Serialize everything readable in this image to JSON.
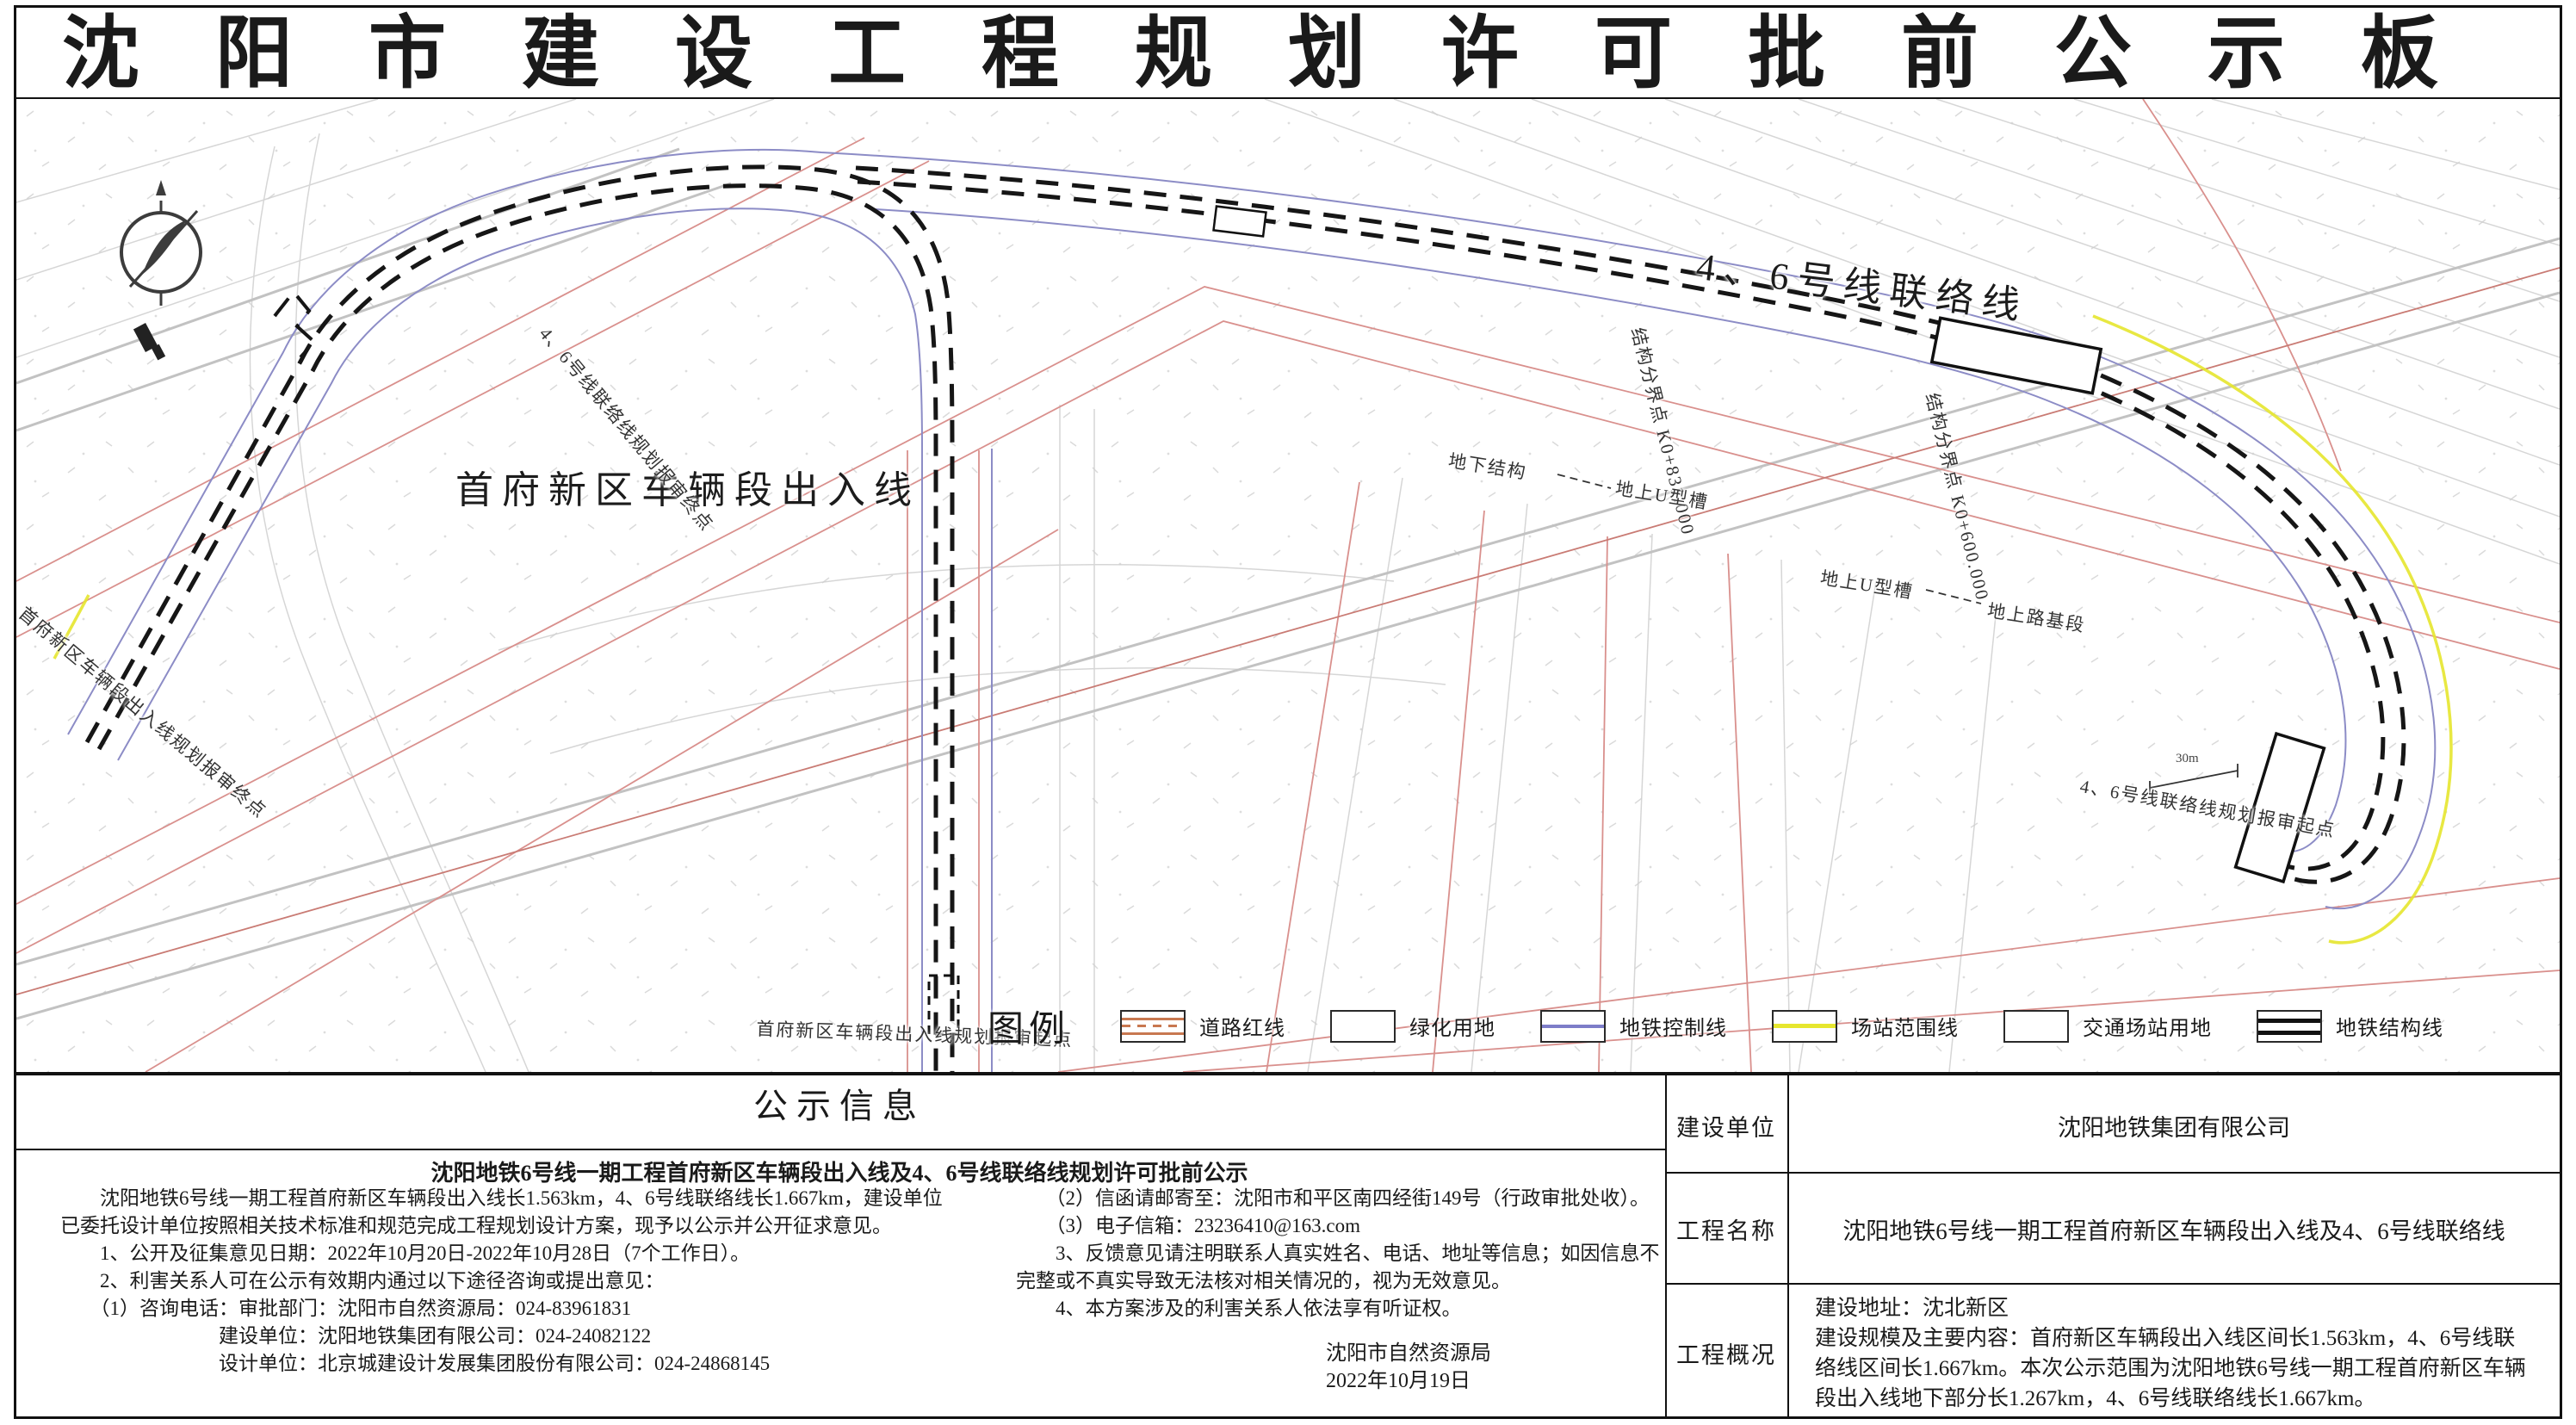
{
  "title": "沈阳市建设工程规划许可批前公示板",
  "map": {
    "labels": {
      "depot_line": "首府新区车辆段出入线",
      "line46": "4、6号线联络线",
      "boundary_k0831": "结构分界点 K0+831.000",
      "boundary_k0600": "结构分界点 K0+600.000",
      "underground_structure": "地下结构",
      "surface_u_trough_1": "地上U型槽",
      "surface_u_trough_2": "地上U型槽",
      "surface_roadbed": "地上路基段",
      "depot_start": "首府新区车辆段出入线规划报审起点",
      "depot_end": "首府新区车辆段出入线规划报审终点",
      "line46_start": "4、6号线联络线规划报审起点",
      "line46_end": "4、6号线联络线规划报审终点",
      "scale_mark": "30m"
    },
    "legend": {
      "title": "图例",
      "items": [
        {
          "label": "道路红线",
          "type": "road-red-line"
        },
        {
          "label": "绿化用地",
          "type": "green-land"
        },
        {
          "label": "地铁控制线",
          "type": "metro-control-line"
        },
        {
          "label": "场站范围线",
          "type": "station-range-line"
        },
        {
          "label": "交通场站用地",
          "type": "transport-station-land"
        },
        {
          "label": "地铁结构线",
          "type": "metro-structure-line"
        }
      ]
    }
  },
  "info": {
    "section_title": "公示信息",
    "notice_title": "沈阳地铁6号线一期工程首府新区车辆段出入线及4、6号线联络线规划许可批前公示",
    "body_left": "　　沈阳地铁6号线一期工程首府新区车辆段出入线长1.563km，4、6号线联络线长1.667km，建设单位已委托设计单位按照相关技术标准和规范完成工程规划设计方案，现予以公示并公开征求意见。\n　　1、公开及征集意见日期：2022年10月20日-2022年10月28日（7个工作日）。\n　　2、利害关系人可在公示有效期内通过以下途径咨询或提出意见：\n　　（1）咨询电话：审批部门：沈阳市自然资源局：024-83961831\n　　　　　　　　建设单位：沈阳地铁集团有限公司：024-24082122\n　　　　　　　　设计单位：北京城建设计发展集团股份有限公司：024-24868145",
    "body_right": "　　（2）信函请邮寄至：沈阳市和平区南四经街149号（行政审批处收）。\n　　（3）电子信箱：23236410@163.com\n　　3、反馈意见请注明联系人真实姓名、电话、地址等信息；如因信息不完整或不真实导致无法核对相关情况的，视为无效意见。\n　　4、本方案涉及的利害关系人依法享有听证权。",
    "signature_org": "沈阳市自然资源局",
    "signature_date": "2022年10月19日"
  },
  "project": {
    "rows": [
      {
        "label": "建设单位",
        "value": "沈阳地铁集团有限公司"
      },
      {
        "label": "工程名称",
        "value": "沈阳地铁6号线一期工程首府新区车辆段出入线及4、6号线联络线"
      },
      {
        "label": "工程概况",
        "value": "建设地址：沈北新区\n建设规模及主要内容：首府新区车辆段出入线区间长1.563km，4、6号线联络线区间长1.667km。本次公示范围为沈阳地铁6号线一期工程首府新区车辆段出入线地下部分长1.267km，4、6号线联络线长1.667km。"
      }
    ]
  },
  "colors": {
    "ink": "#1a1a1a",
    "road_red": "#c87850",
    "metro_blue": "#7d7dc8",
    "station_yellow": "#e6e62e",
    "map_pink": "#d9908d",
    "map_gray": "#c9c9c9"
  }
}
